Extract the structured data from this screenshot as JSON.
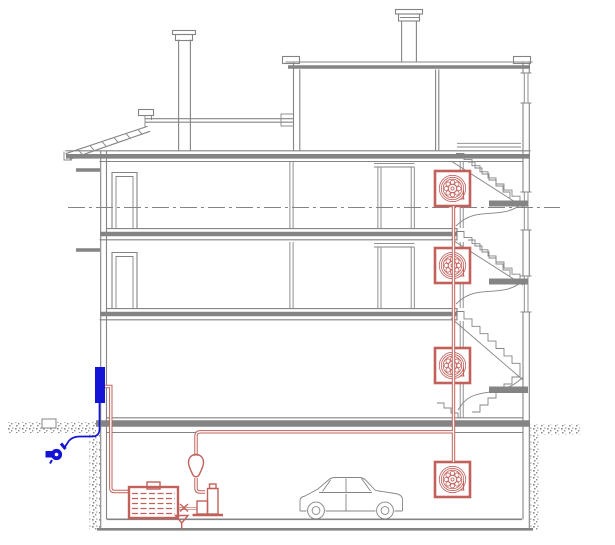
{
  "drawing": {
    "kind": "building-cross-section-cad-drawing",
    "background": "#ffffff",
    "colors": {
      "structure": "#848484",
      "fire": "#c2605a",
      "supply": "#1414d6",
      "hatch": "#8a8a8a",
      "background": "#ffffff"
    },
    "symbols": [
      {
        "name": "hose-reel-cabinet",
        "count": 4,
        "color_key": "fire"
      },
      {
        "name": "standpipe-riser-pipe",
        "count": 1,
        "color_key": "fire"
      },
      {
        "name": "fire-pump-unit",
        "count": 1,
        "color_key": "fire"
      },
      {
        "name": "water-storage-tank",
        "count": 1,
        "color_key": "fire"
      },
      {
        "name": "expansion-vessel",
        "count": 1,
        "color_key": "fire"
      },
      {
        "name": "drain-funnel",
        "count": 1,
        "color_key": "fire"
      },
      {
        "name": "fire-department-connection",
        "count": 1,
        "color_key": "supply"
      },
      {
        "name": "supply-nozzle",
        "count": 1,
        "color_key": "supply"
      },
      {
        "name": "car",
        "count": 1,
        "color_key": "structure"
      },
      {
        "name": "chimney",
        "count": 2,
        "color_key": "structure"
      },
      {
        "name": "staircase-flight",
        "count": 3,
        "color_key": "structure"
      },
      {
        "name": "section-centerline",
        "count": 1,
        "color_key": "structure"
      }
    ]
  }
}
